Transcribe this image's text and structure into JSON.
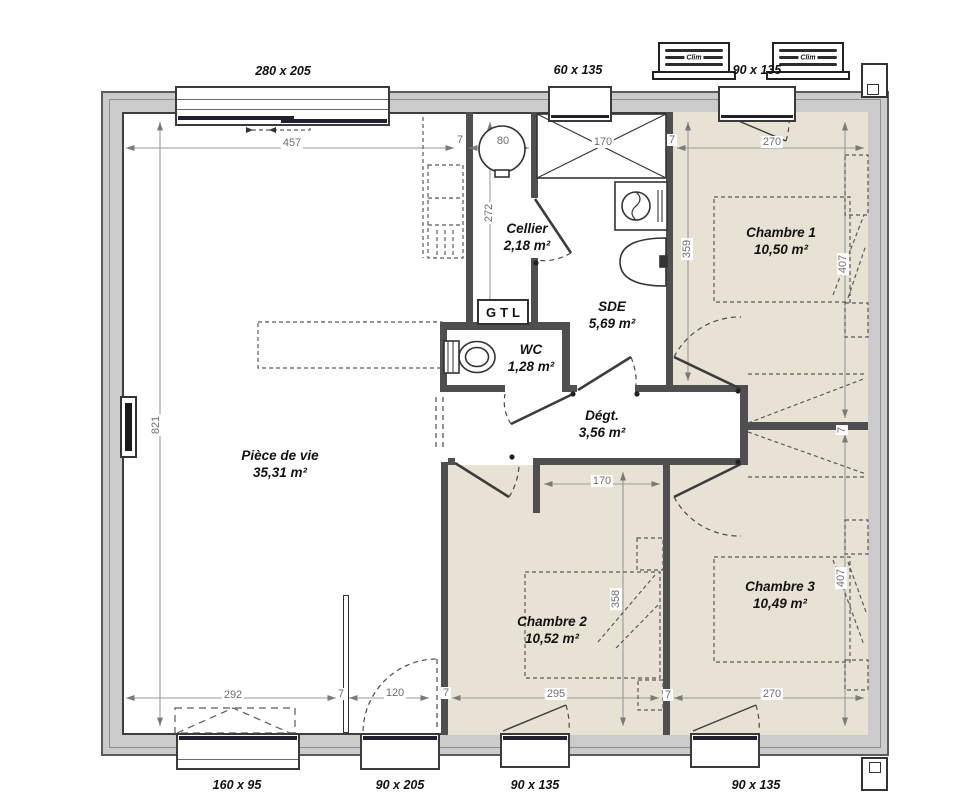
{
  "plan": {
    "type": "house-floor-plan",
    "rooms": [
      {
        "name": "Pièce de vie",
        "area": "35,31 m²"
      },
      {
        "name": "Cellier",
        "area": "2,18 m²"
      },
      {
        "name": "SDE",
        "area": "5,69 m²"
      },
      {
        "name": "WC",
        "area": "1,28 m²"
      },
      {
        "name": "Dégt.",
        "area": "3,56 m²"
      },
      {
        "name": "Chambre 1",
        "area": "10,50 m²"
      },
      {
        "name": "Chambre 2",
        "area": "10,52 m²"
      },
      {
        "name": "Chambre 3",
        "area": "10,49 m²"
      }
    ],
    "openings": {
      "top": [
        "280 x 205",
        "60 x 135",
        "90 x 135"
      ],
      "bottom": [
        "160 x 95",
        "90 x 205",
        "90 x 135",
        "90 x 135"
      ]
    },
    "dimensions": {
      "top_457": "457",
      "top_7a": "7",
      "top_80": "80",
      "top_170": "170",
      "top_7b": "7",
      "top_270": "270",
      "v_272": "272",
      "v_359": "359",
      "v_407_ch1": "407",
      "v_821": "821",
      "mid_170": "170",
      "wall_7": "7",
      "v_358": "358",
      "v_407_ch3": "407",
      "bot_292": "292",
      "bot_7a": "7",
      "bot_120": "120",
      "bot_7b": "7",
      "bot_295": "295",
      "bot_7c": "7",
      "bot_270": "270"
    },
    "equipment": {
      "gtl": "GTL",
      "clim": "Clim"
    },
    "colors": {
      "bedroom_floor": "#e7e2d4",
      "wall_fill": "#cbcbcb",
      "wall_line": "#4f4f4f",
      "dimension_text": "#6e6e6e",
      "window_track": "#20202e"
    }
  }
}
